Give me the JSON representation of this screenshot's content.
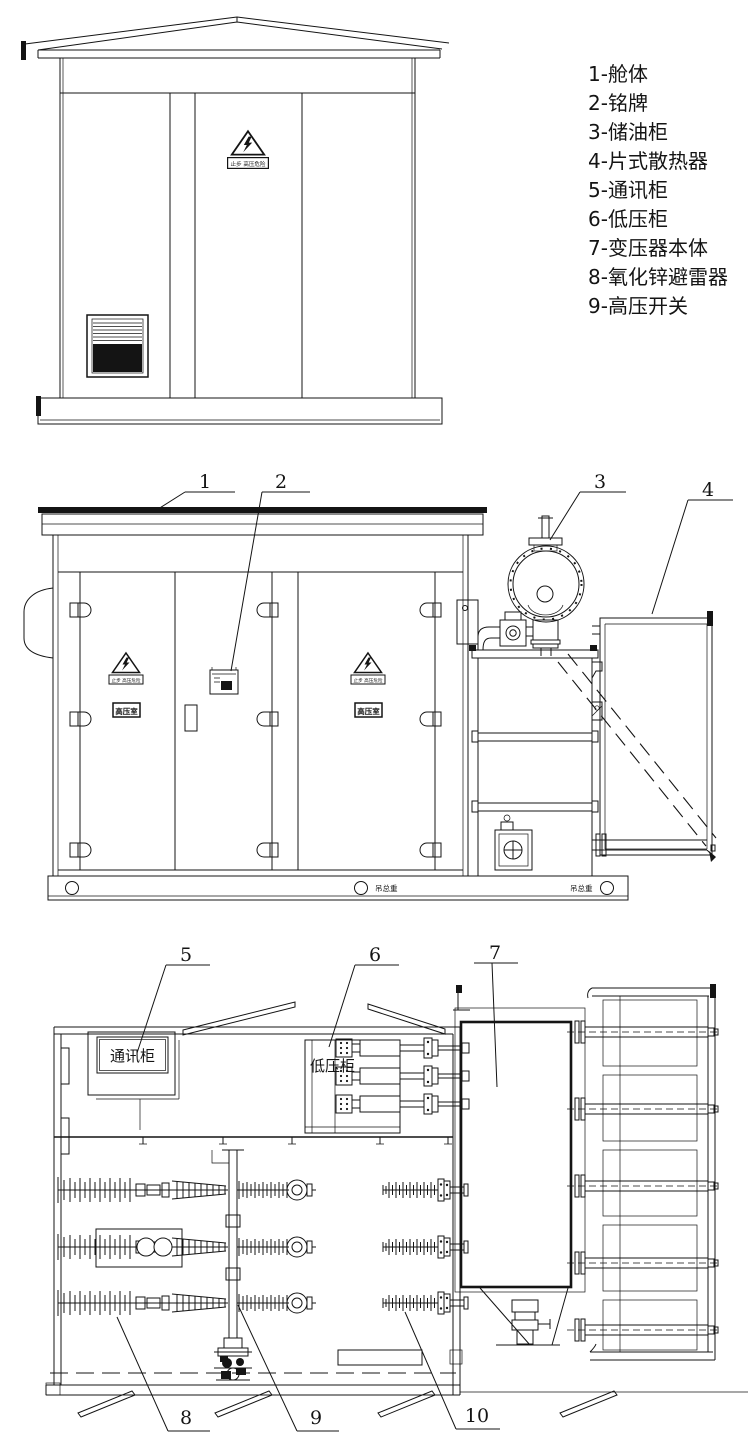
{
  "title": "箱式变电站结构图",
  "legend": {
    "items": [
      "1-舱体",
      "2-铭牌",
      "3-储油柜",
      "4-片式散热器",
      "5-通讯柜",
      "6-低压柜",
      "7-变压器本体",
      "8-氧化锌避雷器",
      "9-高压开关"
    ]
  },
  "callouts": {
    "c1": "1",
    "c2": "2",
    "c3": "3",
    "c4": "4",
    "c5": "5",
    "c6": "6",
    "c7": "7",
    "c8": "8",
    "c9": "9",
    "c10": "10"
  },
  "labels": {
    "warning_sign": "止步 高压危险",
    "hv_room": "高压室",
    "comm_cabinet": "通讯柜",
    "lv_cabinet": "低压柜",
    "lift_weight": "吊总重"
  },
  "colors": {
    "line": "#141414",
    "background": "#ffffff"
  }
}
